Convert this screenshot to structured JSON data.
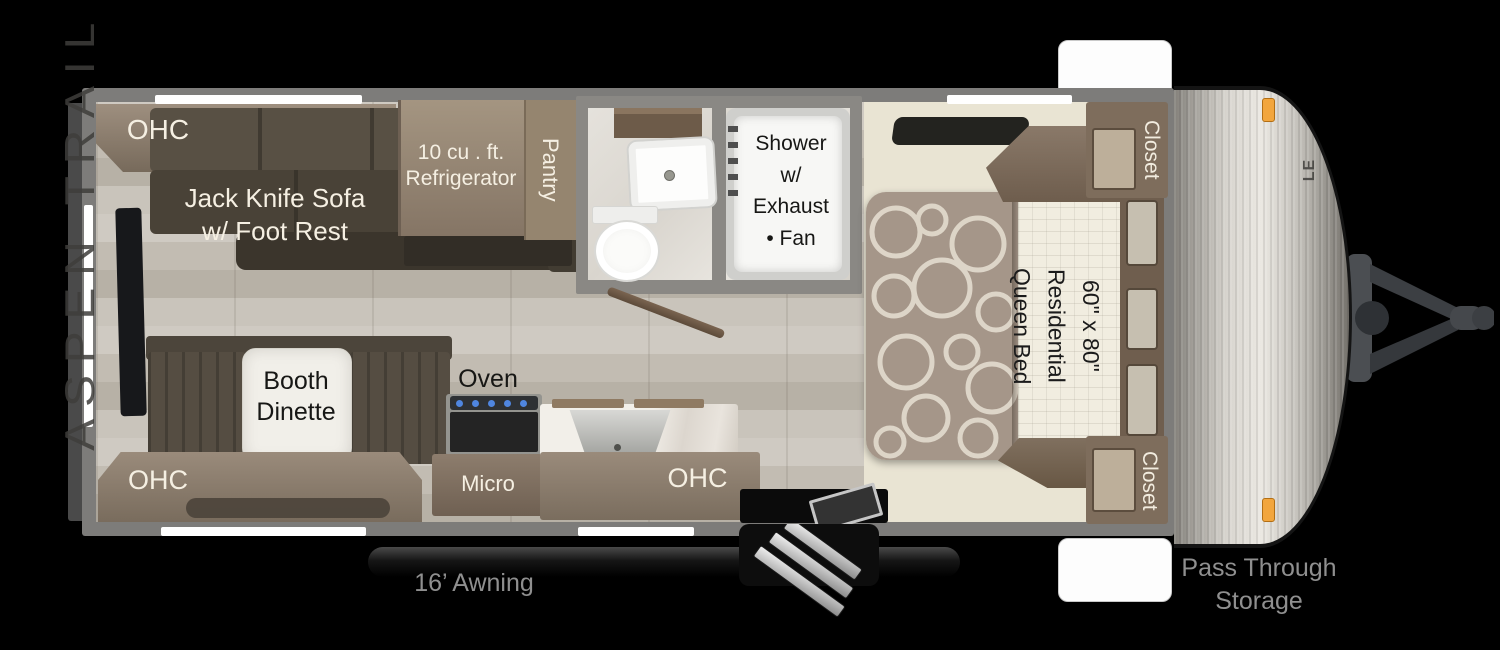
{
  "title": "Aspen Trail LE travel trailer floor plan",
  "colors": {
    "background": "#000000",
    "wall_gray": "#7d7c7a",
    "plank_floor": "#c6c1b8",
    "bedroom_floor": "#e9e4d3",
    "cabinet_brown": "#8d7d6d",
    "sofa_brown": "#4a4238",
    "marble_white": "#f1efe9",
    "front_cap_silver": "#d7d4ce",
    "marker_light_orange": "#f2a63e",
    "burner_blue": "#4f86e0",
    "label_light": "#f5efe2",
    "label_dark": "#171715",
    "label_gray": "#8f8f8f"
  },
  "living": {
    "ohc_top": "OHC",
    "sofa": "Jack Knife Sofa\nw/ Foot Rest",
    "dinette": "Booth\nDinette",
    "ohc_bottom": "OHC"
  },
  "kitchen": {
    "refrigerator": "10 cu . ft.\nRefrigerator",
    "pantry": "Pantry",
    "oven": "Oven",
    "micro": "Micro",
    "ohc": "OHC"
  },
  "bathroom": {
    "shower": "Shower\nw/\nExhaust\n• Fan"
  },
  "bedroom": {
    "bed": "60\" x 80\"\nResidential\nQueen Bed",
    "closet_top": "Closet",
    "closet_bottom": "Closet"
  },
  "exterior": {
    "awning": "16’ Awning",
    "pass_through": "Pass Through\nStorage",
    "brand": "ASPEN TRAIL",
    "brand_sub": "LE"
  }
}
